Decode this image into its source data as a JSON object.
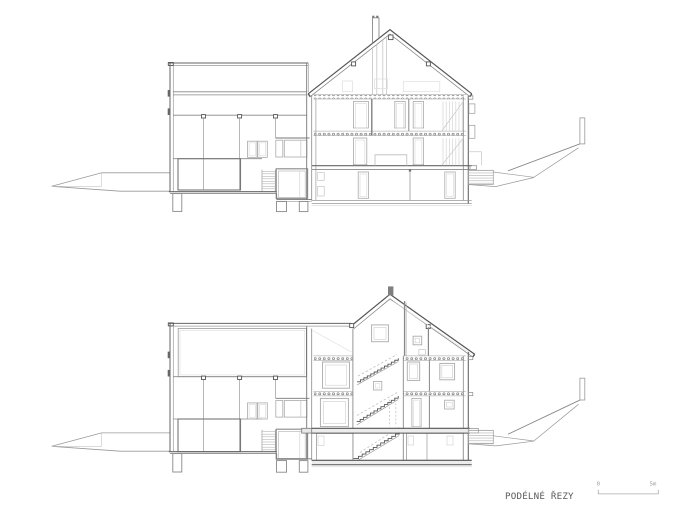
{
  "document": {
    "title": "PODÉLNÉ ŘEZY",
    "scale_bar": {
      "start_label": "0",
      "end_label": "5m"
    }
  },
  "colors": {
    "background": "#ffffff",
    "cut_line": "#555555",
    "medium_line": "#888888",
    "light_line": "#bbbbbb",
    "text": "#666666"
  }
}
